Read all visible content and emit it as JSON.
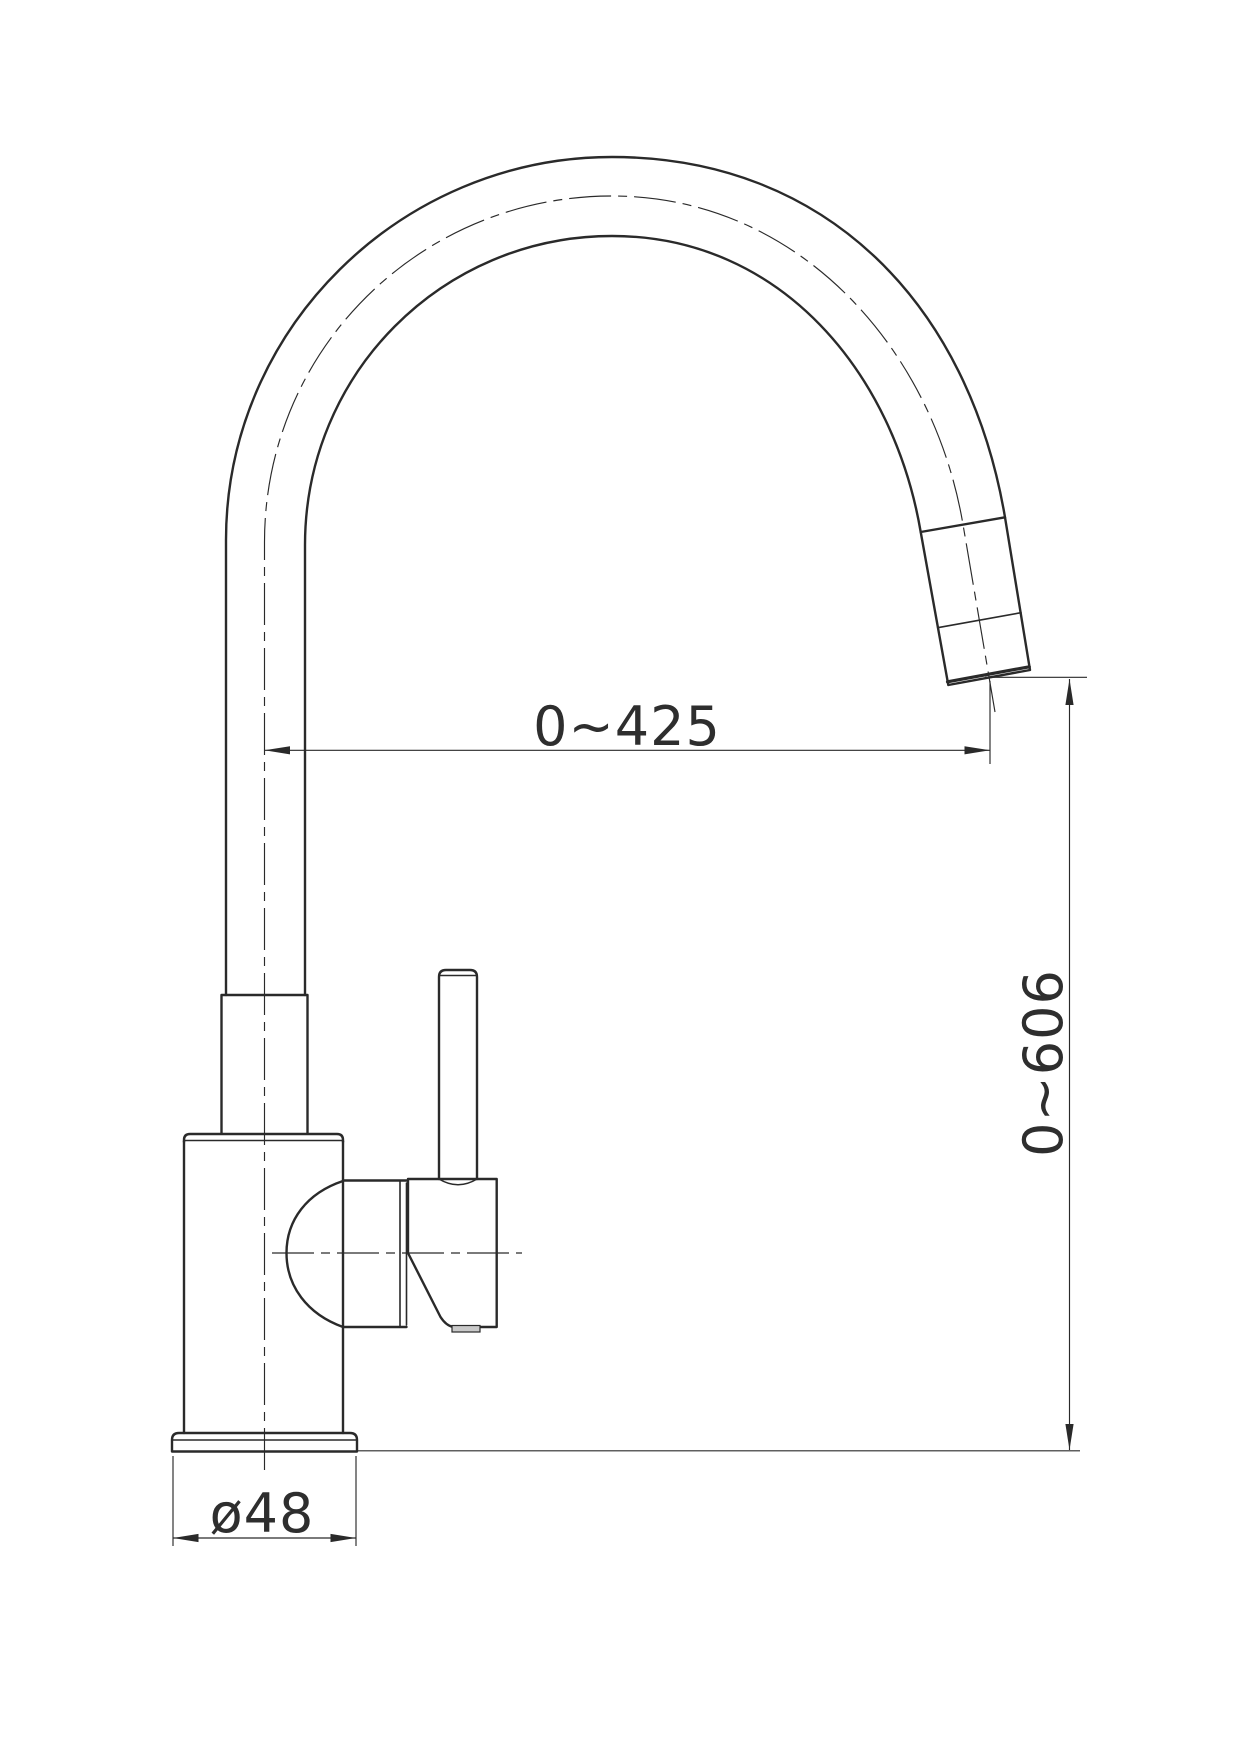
{
  "drawing": {
    "title": "Pull-out kitchen faucet — side elevation technical drawing",
    "background_color": "#ffffff",
    "line_color": "#2a2a2a",
    "dimensions": {
      "spout_reach": {
        "label": "0~425"
      },
      "spout_height": {
        "label": "0~606"
      },
      "base_diameter": {
        "label": "ø48"
      }
    }
  }
}
